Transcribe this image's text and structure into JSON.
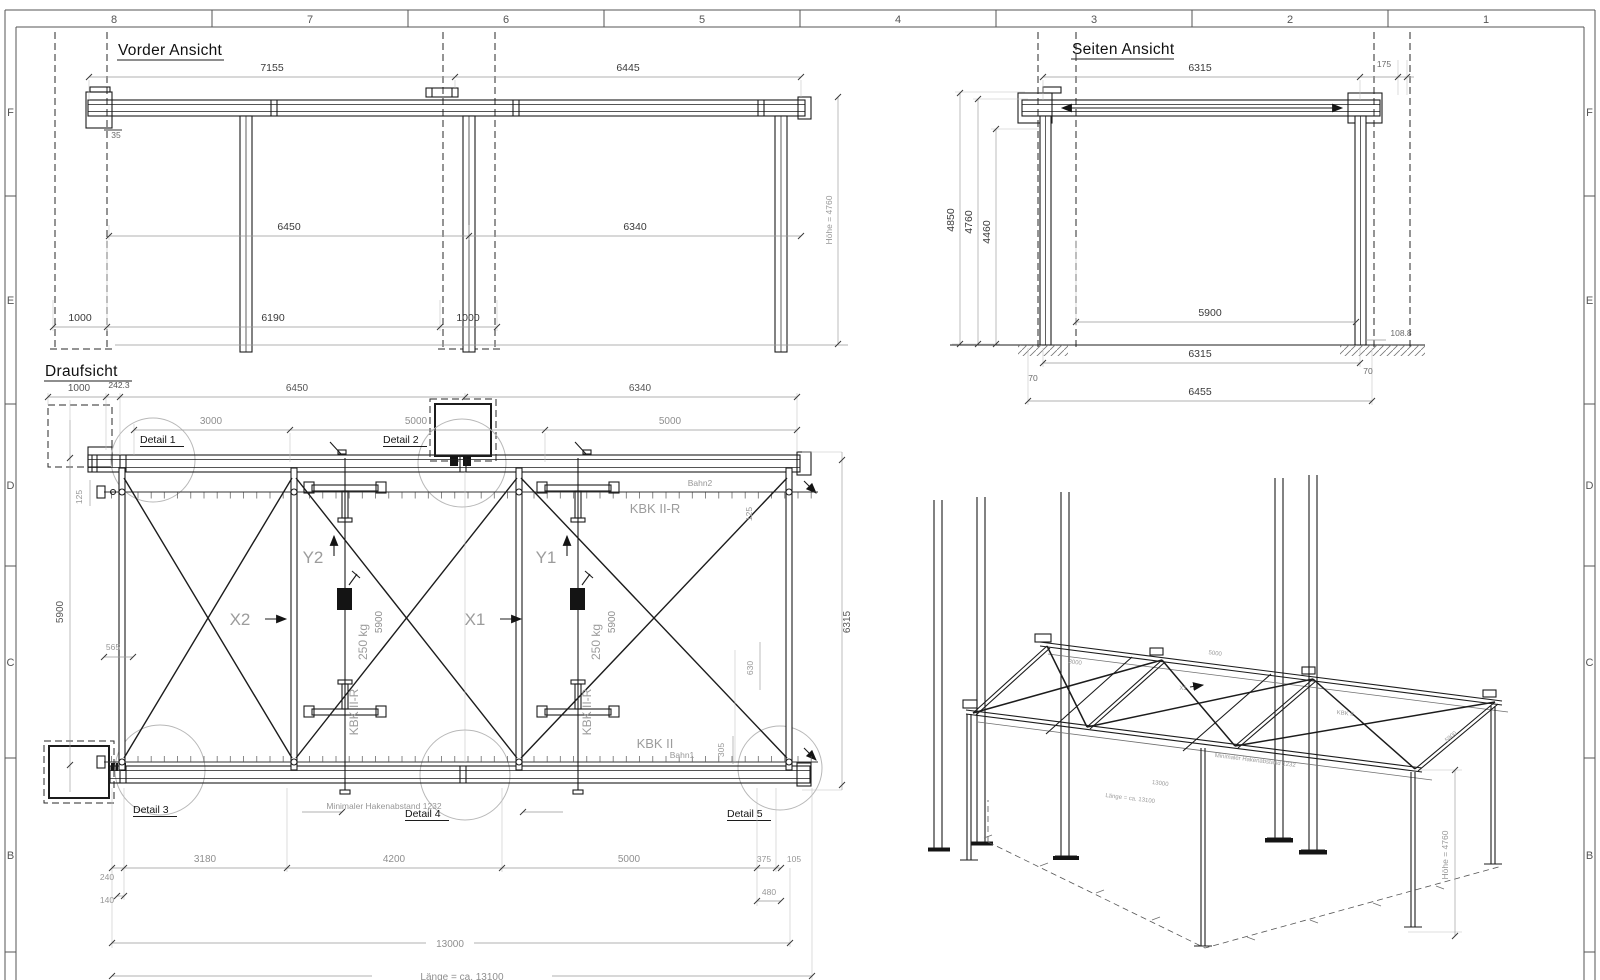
{
  "sheet": {
    "grid_columns": [
      "8",
      "7",
      "6",
      "5",
      "4",
      "3",
      "2",
      "1"
    ],
    "grid_rows": [
      "F",
      "E",
      "D",
      "C",
      "B"
    ],
    "line_color": "#1c1c1c",
    "dim_color": "#8f8f8f"
  },
  "front_view": {
    "title": "Vorder Ansicht",
    "d7155": "7155",
    "d6445": "6445",
    "d6450": "6450",
    "d6340": "6340",
    "d6190": "6190",
    "d1000a": "1000",
    "d1000b": "1000",
    "d35": "35",
    "hoehe": "Höhe = 4760"
  },
  "side_view": {
    "title": "Seiten Ansicht",
    "d6315t": "6315",
    "d175": "175",
    "d4850": "4850",
    "d4760": "4760",
    "d4460": "4460",
    "d5900": "5900",
    "d1088": "108.8",
    "d6315b": "6315",
    "d70a": "70",
    "d70b": "70",
    "d6455": "6455"
  },
  "plan_view": {
    "title": "Draufsicht",
    "d1000": "1000",
    "d2423": "242.3",
    "d6450": "6450",
    "d6340": "6340",
    "d3000": "3000",
    "d5000a": "5000",
    "d5000b": "5000",
    "det1": "Detail 1",
    "det2": "Detail 2",
    "det3": "Detail 3",
    "det4": "Detail 4",
    "det5": "Detail 5",
    "d125a": "125",
    "d125b": "125",
    "d5900_left": "5900",
    "d565": "565",
    "bahn2": "Bahn2",
    "kbk_rail2": "KBK II-R",
    "kbk_rail1": "KBK II",
    "bahn1": "Bahn1",
    "x2": "X2",
    "x1": "X1",
    "y2": "Y2",
    "y1": "Y1",
    "load1": "250 kg",
    "load2": "250 kg",
    "kbk_mono1": "KBK II-R",
    "kbk_mono2": "KBK II-R",
    "d5900m1": "5900",
    "d5900m2": "5900",
    "d6315_right": "6315",
    "d630": "630",
    "d305": "305",
    "hook_note": "Minimaler Hakenabstand 1232",
    "d3180": "3180",
    "d4200": "4200",
    "d5000c": "5000",
    "d375": "375",
    "d105": "105",
    "d240": "240",
    "d140": "140",
    "d480": "480",
    "d13000": "13000",
    "laenge": "Länge = ca. 13100"
  },
  "iso_view": {
    "hoehe": "Höhe = 4760",
    "m3000": "3000",
    "m5000": "5000",
    "mkbk": "KBK II",
    "m13000": "13000",
    "mlaenge": "Länge = ca. 13100",
    "mhaken": "Minimaler Hakenabstand 1232",
    "m5900": "5900",
    "mx1": "X1"
  }
}
